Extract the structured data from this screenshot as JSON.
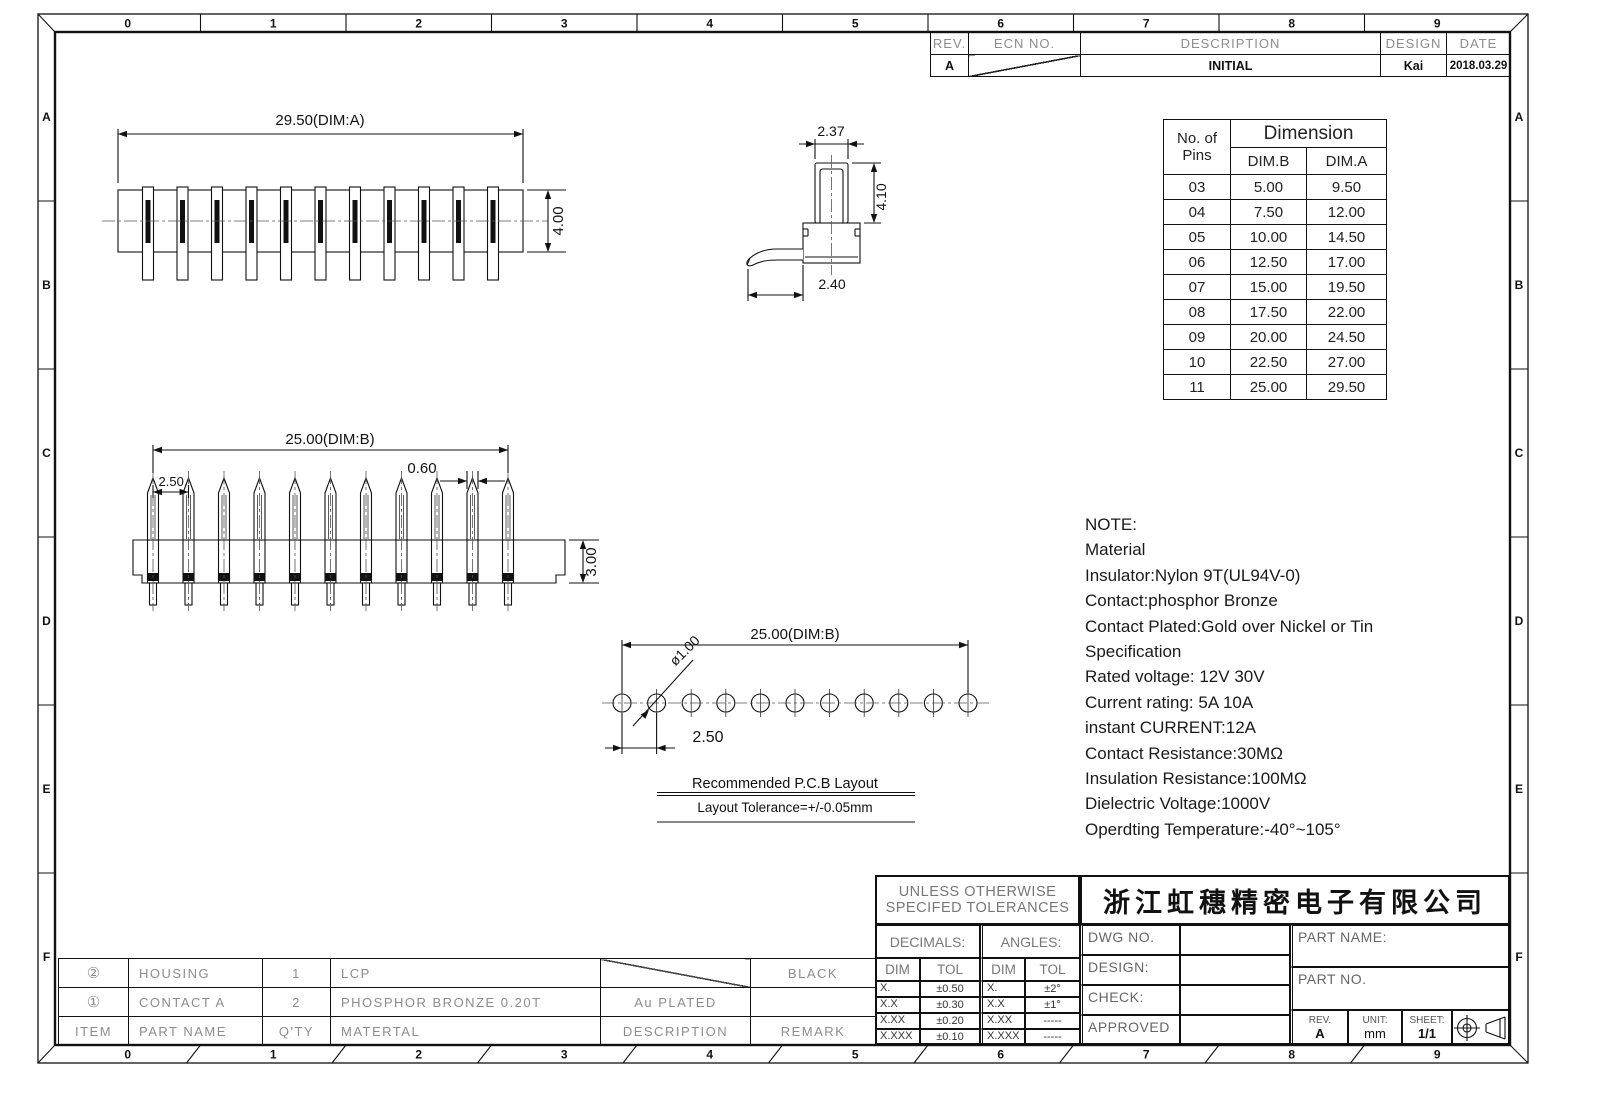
{
  "frame": {
    "top_zones": [
      "0",
      "1",
      "2",
      "3",
      "4",
      "5",
      "6",
      "7",
      "8",
      "9"
    ],
    "bottom_zones": [
      "0",
      "1",
      "2",
      "3",
      "4",
      "5",
      "6",
      "7",
      "8",
      "9"
    ],
    "left_zones": [
      "A",
      "B",
      "C",
      "D",
      "E",
      "F"
    ],
    "right_zones": [
      "A",
      "B",
      "C",
      "D",
      "E",
      "F"
    ]
  },
  "revision_table": {
    "headers": [
      "REV.",
      "ECN NO.",
      "DESCRIPTION",
      "DESIGN",
      "DATE"
    ],
    "row": {
      "rev": "A",
      "ecn": "",
      "description": "INITIAL",
      "design": "Kai",
      "date": "2018.03.29"
    }
  },
  "dimension_table": {
    "pins_header": [
      "No. of",
      "Pins"
    ],
    "dimension_header": "Dimension",
    "col_headers": [
      "DIM.B",
      "DIM.A"
    ],
    "rows": [
      [
        "03",
        "5.00",
        "9.50"
      ],
      [
        "04",
        "7.50",
        "12.00"
      ],
      [
        "05",
        "10.00",
        "14.50"
      ],
      [
        "06",
        "12.50",
        "17.00"
      ],
      [
        "07",
        "15.00",
        "19.50"
      ],
      [
        "08",
        "17.50",
        "22.00"
      ],
      [
        "09",
        "20.00",
        "24.50"
      ],
      [
        "10",
        "22.50",
        "27.00"
      ],
      [
        "11",
        "25.00",
        "29.50"
      ]
    ]
  },
  "notes": {
    "lines": [
      "NOTE:",
      "Material",
      "Insulator:Nylon 9T(UL94V-0)",
      "Contact:phosphor Bronze",
      "Contact Plated:Gold over Nickel or Tin",
      "Specification",
      "Rated voltage: 12V 30V",
      "Current rating: 5A 10A",
      "instant CURRENT:12A",
      "Contact Resistance:30MΩ",
      "Insulation Resistance:100MΩ",
      "Dielectric Voltage:1000V",
      "Operdting Temperature:-40°~105°"
    ]
  },
  "views": {
    "top_view": {
      "pin_count": 11,
      "dim_width": "29.50(DIM:A)",
      "dim_height": "4.00"
    },
    "side_view": {
      "dim_top": "2.37",
      "dim_side": "4.10",
      "dim_bottom": "2.40"
    },
    "front_view": {
      "pin_count": 11,
      "dim_width": "25.00(DIM:B)",
      "dim_pitch": "2.50.",
      "dim_pin_width": "0.60",
      "dim_base_height": "3.00"
    },
    "pcb_layout": {
      "hole_count": 11,
      "dim_width": "25.00(DIM:B)",
      "dim_hole_dia": "ø1.00",
      "dim_pitch": "2.50",
      "caption": "Recommended P.C.B Layout",
      "tolerance_caption": "Layout Tolerance=+/-0.05mm"
    }
  },
  "parts_table": {
    "headers": [
      "ITEM",
      "PART NAME",
      "Q'TY",
      "MATERTAL",
      "DESCRIPTION",
      "REMARK"
    ],
    "rows": [
      {
        "item": "②",
        "part_name": "HOUSING",
        "qty": "1",
        "material": "LCP",
        "description": "",
        "remark": "BLACK"
      },
      {
        "item": "①",
        "part_name": "CONTACT A",
        "qty": "2",
        "material": "PHOSPHOR BRONZE 0.20T",
        "description": "Au PLATED",
        "remark": ""
      }
    ]
  },
  "title_block": {
    "tolerance_title": [
      "UNLESS OTHERWISE",
      "SPECIFED TOLERANCES"
    ],
    "company": "浙江虹穗精密电子有限公司",
    "decimals_label": "DECIMALS:",
    "angles_label": "ANGLES:",
    "dim_header": "DIM",
    "tol_header": "TOL",
    "decimals_rows": [
      [
        "X.",
        "±0.50"
      ],
      [
        "X.X",
        "±0.30"
      ],
      [
        "X.XX",
        "±0.20"
      ],
      [
        "X.XXX",
        "±0.10"
      ]
    ],
    "angles_rows": [
      [
        "X.",
        "±2°"
      ],
      [
        "X.X",
        "±1°"
      ],
      [
        "X.XX",
        "-----"
      ],
      [
        "X.XXX",
        "-----"
      ]
    ],
    "dwg_no_label": "DWG NO.",
    "design_label": "DESIGN:",
    "check_label": "CHECK:",
    "approved_label": "APPROVED",
    "part_name_label": "PART NAME:",
    "part_no_label": "PART NO.",
    "rev_label": "REV.",
    "rev_value": "A",
    "unit_label": "UNIT:",
    "unit_value": "mm",
    "sheet_label": "SHEET:",
    "sheet_value": "1/1"
  }
}
